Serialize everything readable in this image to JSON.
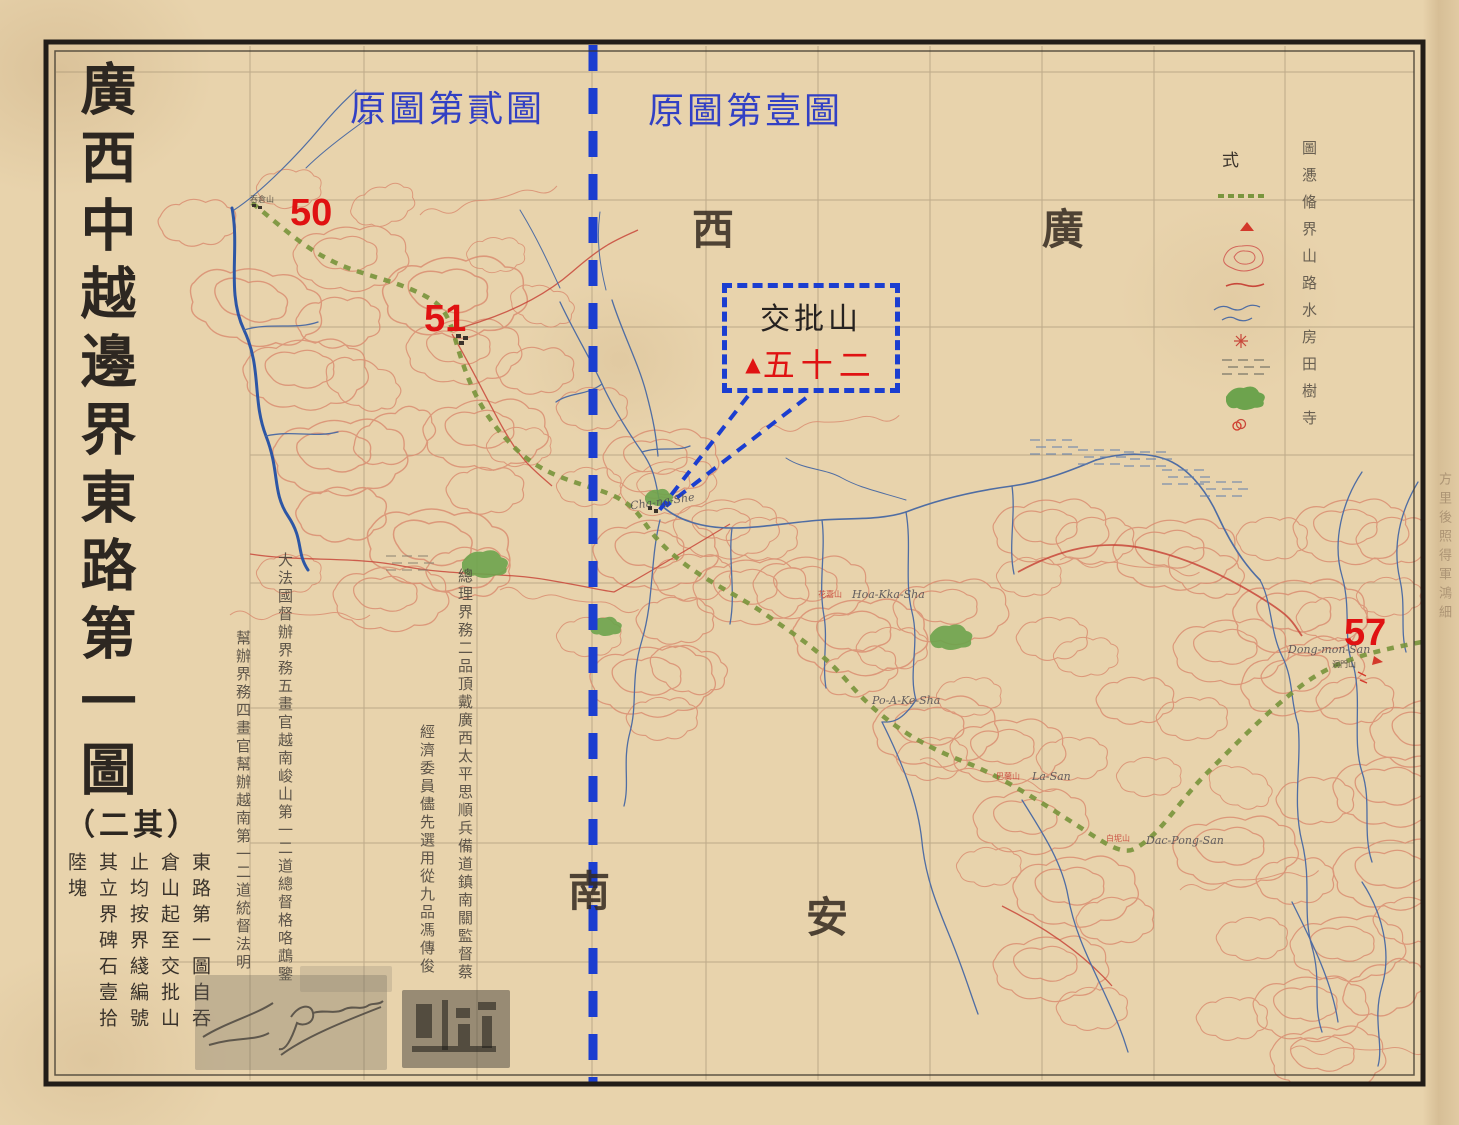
{
  "title": {
    "main": "廣西中越邊界東路第一圖",
    "part": "（二其）",
    "notes": [
      "東路第一圖自吞",
      "倉山起至交批山",
      "止均按界綫編號",
      "其立界碑石壹拾",
      "陸塊"
    ]
  },
  "annotations": {
    "sheet2_label": "原圖第貳圖",
    "sheet1_label": "原圖第壹圖",
    "m50": "50",
    "m51": "51",
    "m57": "57",
    "callout": {
      "name": "交批山",
      "number": "五十二",
      "triangle": "▲"
    }
  },
  "regions": {
    "guang": "廣",
    "xi": "西",
    "an": "安",
    "nan": "南"
  },
  "officials": {
    "dafaguo": "大法國督辦界務五畫官越南峻山第一二道總督格咯鵡鑒",
    "bangban": "幫辦界務四畫官幫辦越南第一二道統督法明",
    "zongli": "總理界務二品頂戴廣西太平思順兵備道鎮南關監督蔡",
    "weiyuan": "經濟委員儘先選用從九品馮傳俊"
  },
  "legend": {
    "header": "式",
    "text_column": "圖慿偹界山路水房田樹寺",
    "symbols": [
      "boundary-line",
      "mountain-peak",
      "mountain-contour",
      "road",
      "river",
      "house",
      "paddy-field",
      "forest",
      "temple"
    ]
  },
  "places": [
    {
      "text": "Cha-ng-She"
    },
    {
      "text": "Hoa-Kka-Sha",
      "cn": "花嘉山"
    },
    {
      "text": "Po-A-Ke-Sha"
    },
    {
      "text": "La-San",
      "cn": "巴蘭山"
    },
    {
      "text": "Dac-Pong-San",
      "cn": "白坭山"
    },
    {
      "text": "Dong-mon-San",
      "cn": "洞門山"
    },
    {
      "text": "吞倉山"
    }
  ],
  "edge_note": "方里後照得軍鴻細",
  "colors": {
    "paper": "#e8d3ac",
    "ink": "#332c24",
    "annotation_blue": "#1b3ed0",
    "annotation_red": "#e01212",
    "boundary_green": "#79953d",
    "contour_red": "#d98a6e",
    "river_blue": "#4f6da3",
    "forest_green": "#6da34d"
  }
}
